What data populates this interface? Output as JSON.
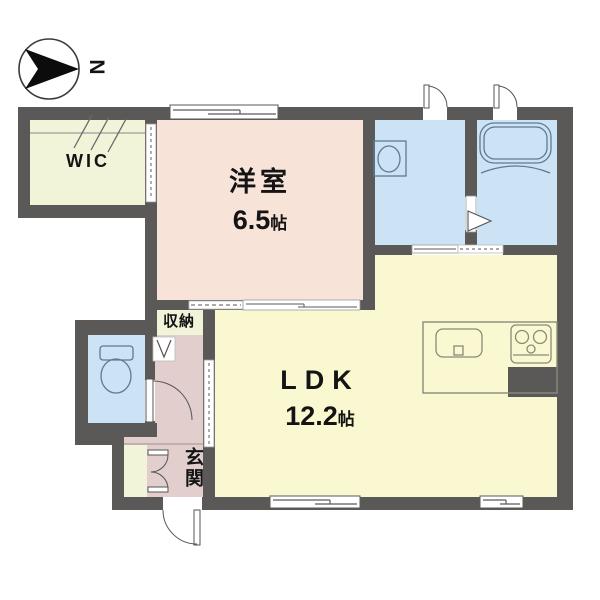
{
  "compass": {
    "label": "N"
  },
  "rooms": {
    "wic": {
      "label": "WIC"
    },
    "western_room": {
      "label": "洋室",
      "size_value": "6.5",
      "size_unit": "帖"
    },
    "ldk": {
      "label": "LDK",
      "size_value": "12.2",
      "size_unit": "帖"
    },
    "storage": {
      "label": "収納"
    },
    "entrance": {
      "label": "玄関"
    }
  },
  "fixtures": [
    "compass",
    "bathtub",
    "washbasin",
    "toilet",
    "kitchen-sink",
    "gas-stove",
    "hinged-door",
    "sliding-door",
    "folding-door",
    "double-closet-door",
    "window"
  ],
  "colors": {
    "wall": "#5b5957",
    "closet_cream": "#f2f4da",
    "western_room_pink": "#f8e3d9",
    "ldk_yellow": "#faf8d0",
    "wet_area_blue": "#cbe3f4",
    "hall_mauve": "#e1cecd",
    "background": "#ffffff",
    "line": "#5a5a5a"
  }
}
